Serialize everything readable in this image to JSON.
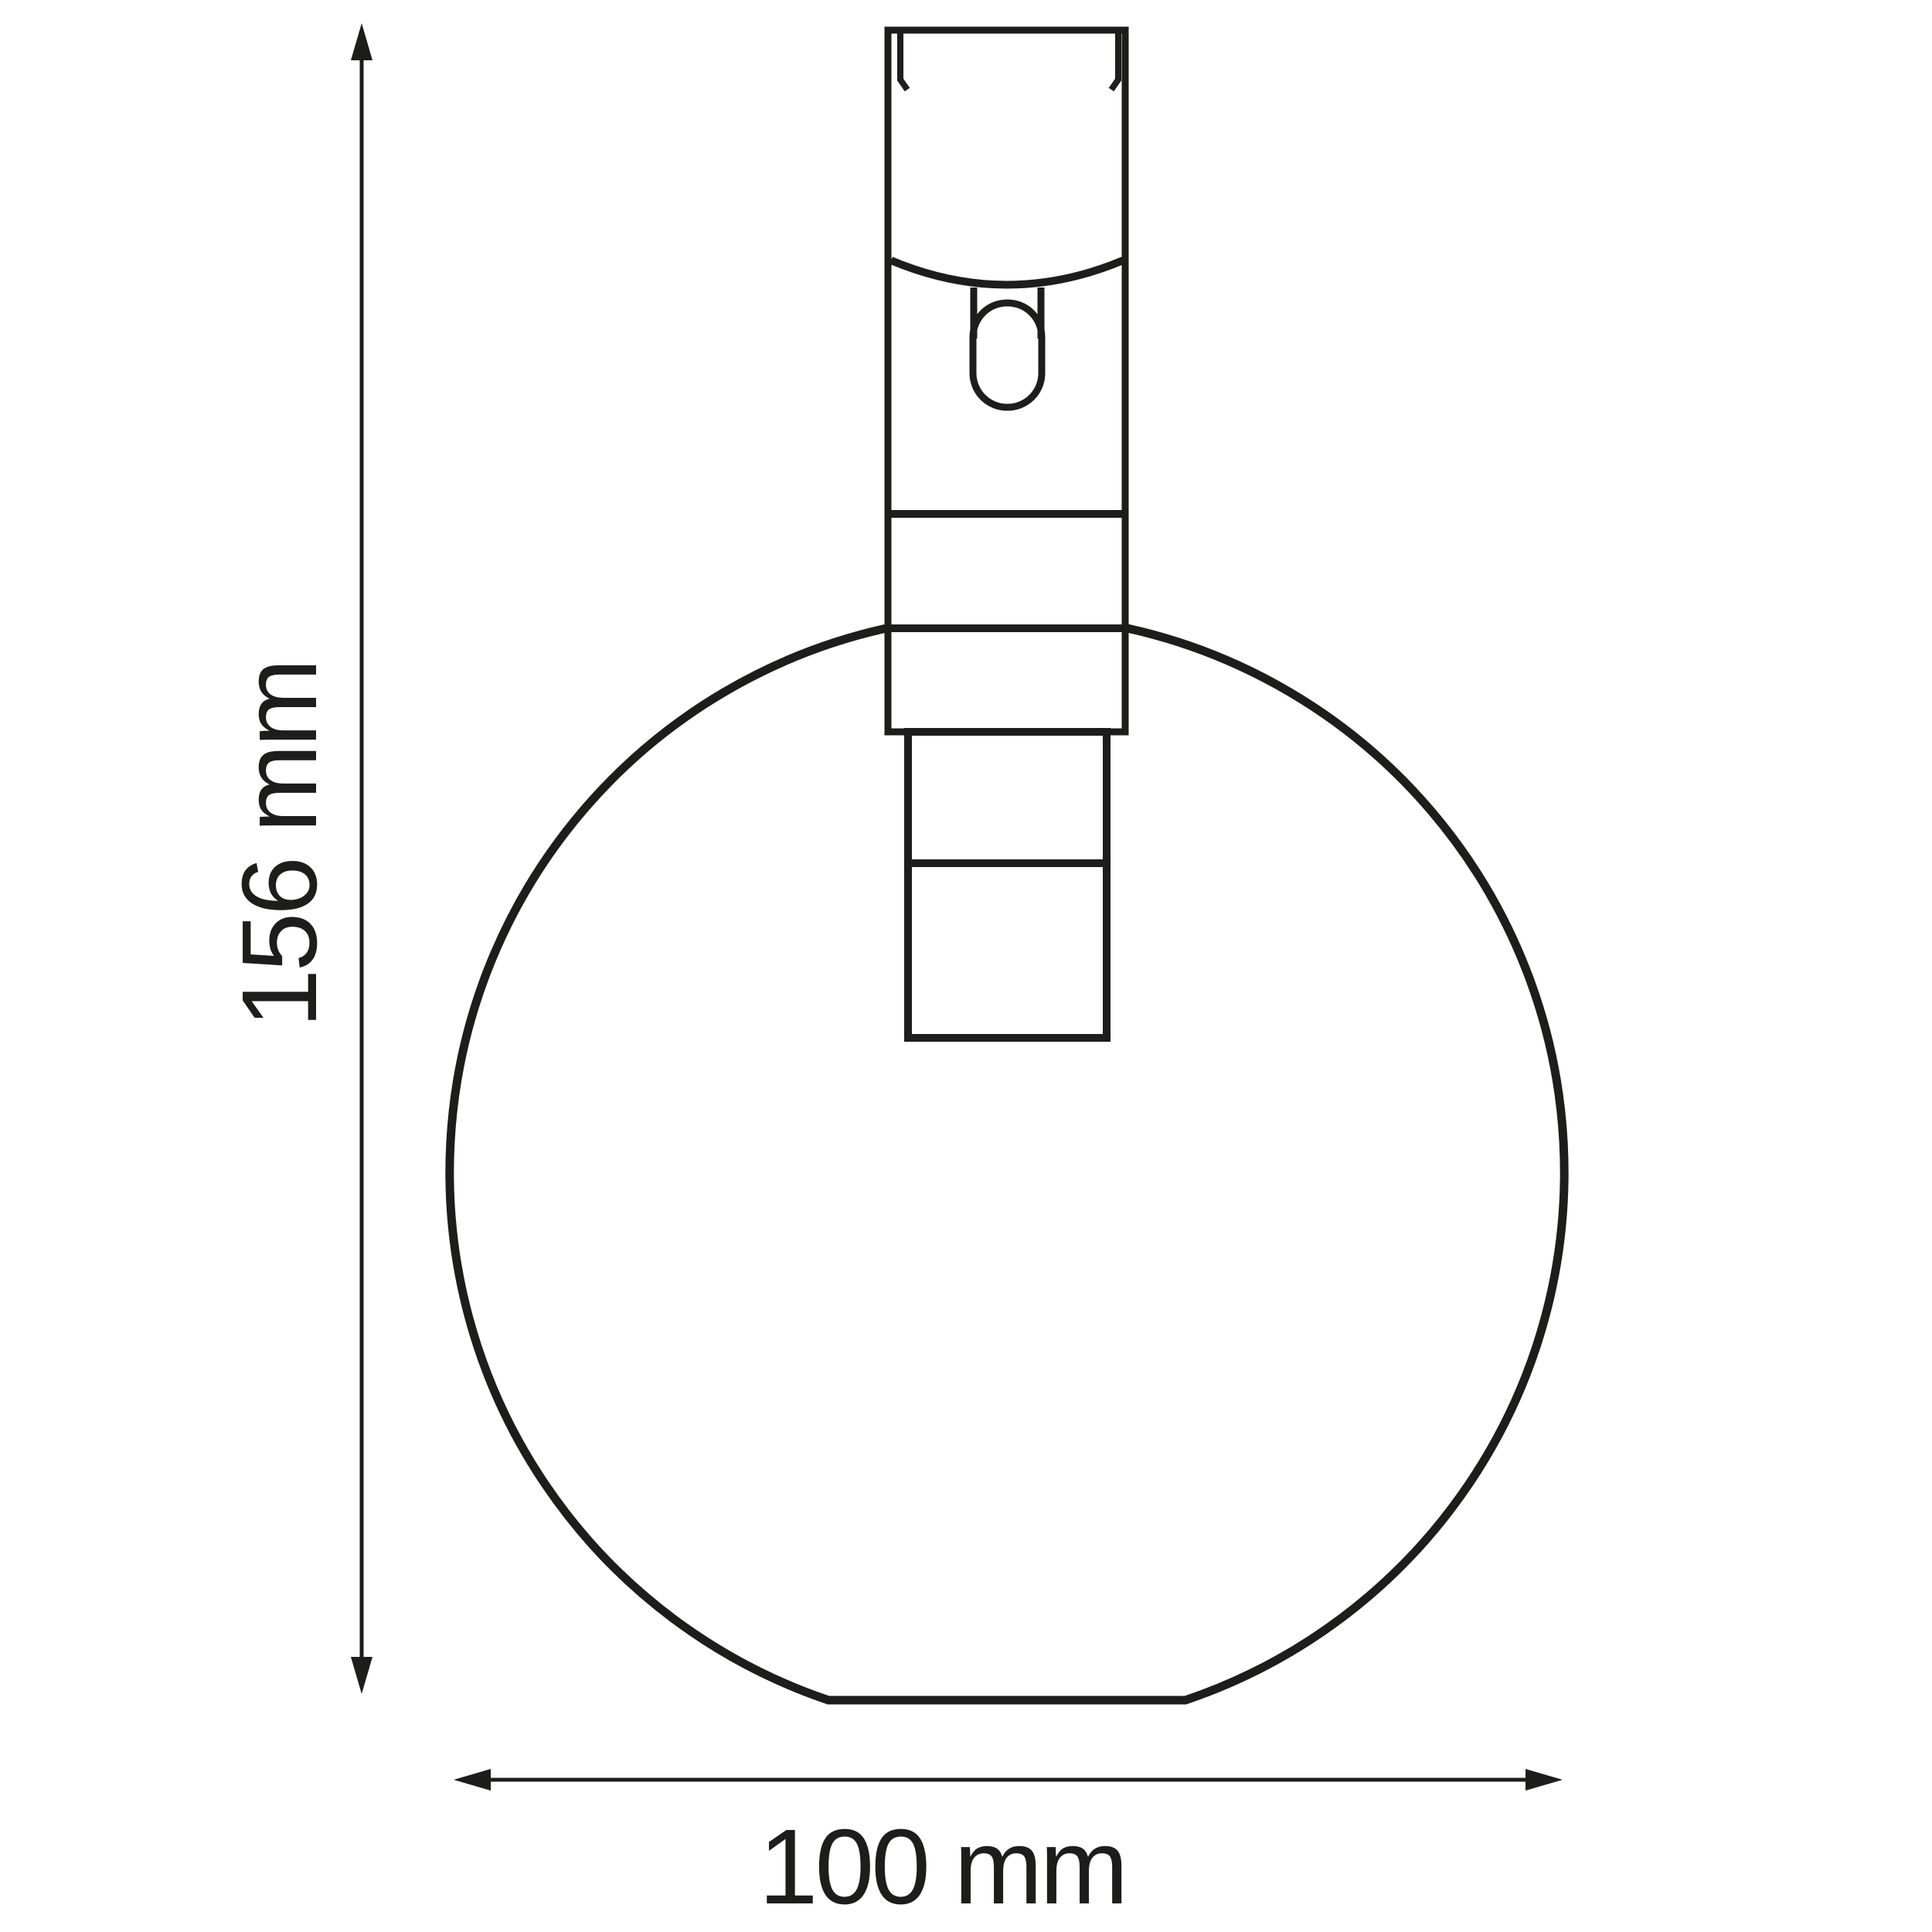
{
  "drawing": {
    "subject": "globe-lamp-shade-dimension-drawing",
    "background_color": "#ffffff",
    "line_color": "#1d1d1b",
    "height_dimension": {
      "label": "156 mm",
      "value": 156,
      "unit": "mm",
      "orientation": "vertical"
    },
    "width_dimension": {
      "label": "100 mm",
      "value": 100,
      "unit": "mm",
      "orientation": "horizontal"
    }
  }
}
